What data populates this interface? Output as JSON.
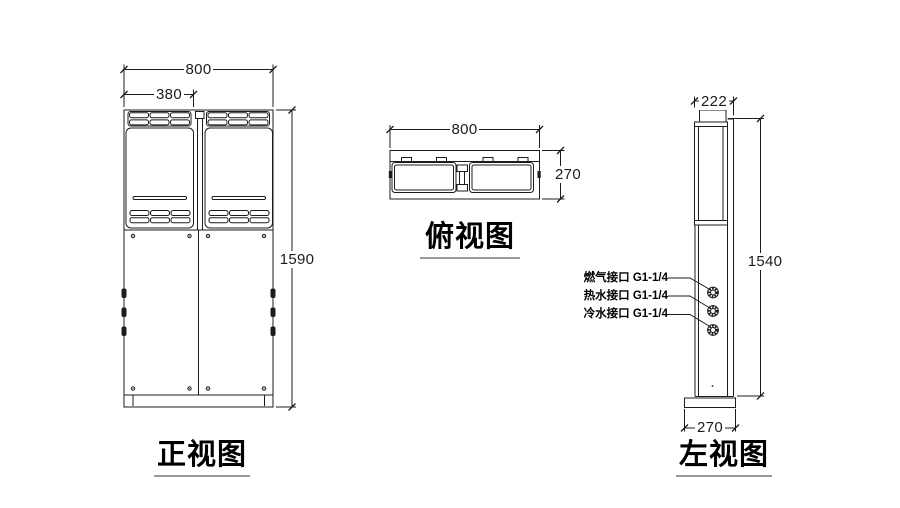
{
  "views": {
    "front": {
      "label": "正视图",
      "dim_width": "800",
      "dim_panel_width": "380",
      "dim_height": "1590"
    },
    "top": {
      "label": "俯视图",
      "dim_width": "800",
      "dim_depth": "270"
    },
    "left": {
      "label": "左视图",
      "dim_depth": "222",
      "dim_height": "1540",
      "dim_base_depth": "270",
      "connections": [
        {
          "label": "燃气接口 G1-1/4"
        },
        {
          "label": "热水接口 G1-1/4"
        },
        {
          "label": "冷水接口 G1-1/4"
        }
      ]
    }
  },
  "colors": {
    "line": "#1c1c1c",
    "underline": "#9a9a9a",
    "background": "#ffffff"
  }
}
